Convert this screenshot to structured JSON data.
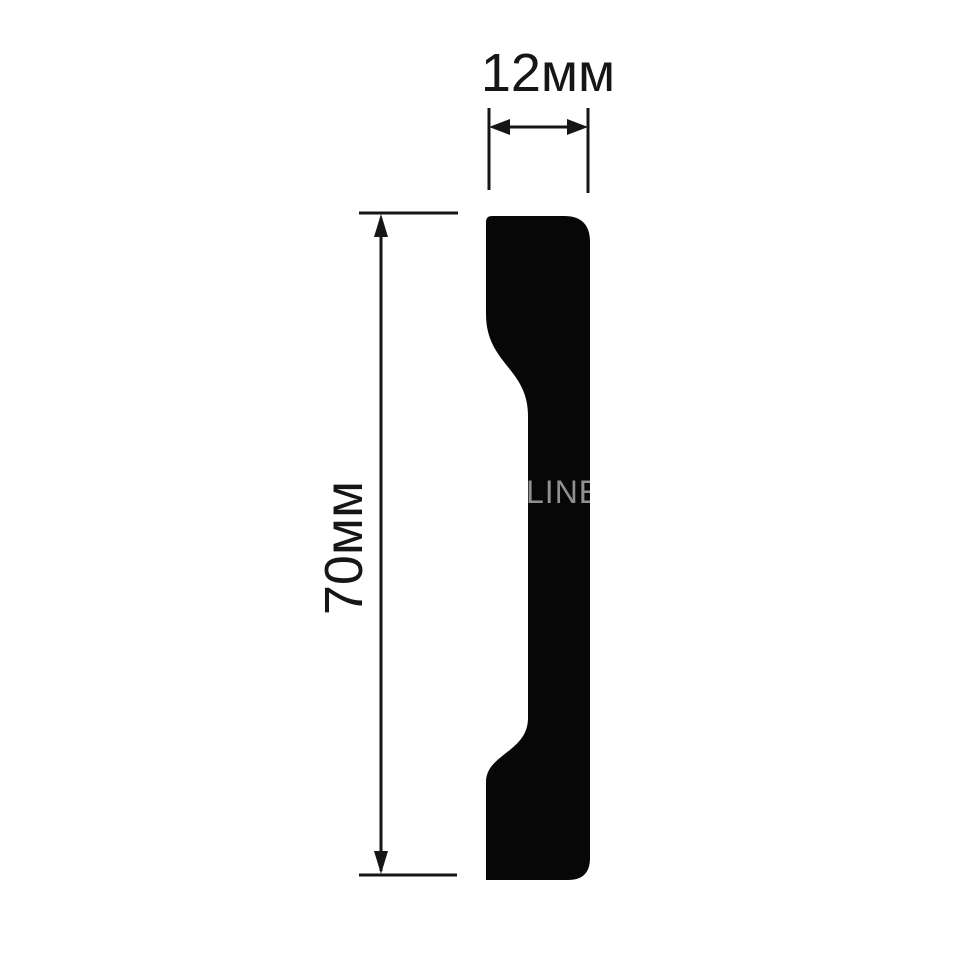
{
  "figure": {
    "background": "#ffffff",
    "profile_color": "#070707",
    "line_color": "#161616"
  },
  "dimensions": {
    "width": {
      "label": "12мм",
      "value": 12,
      "unit": "мм"
    },
    "height": {
      "label": "70мм",
      "value": 70,
      "unit": "мм"
    }
  },
  "watermark": {
    "visible_text": "LINE.",
    "partial_glyph": "O",
    "color": "#8f9092"
  }
}
